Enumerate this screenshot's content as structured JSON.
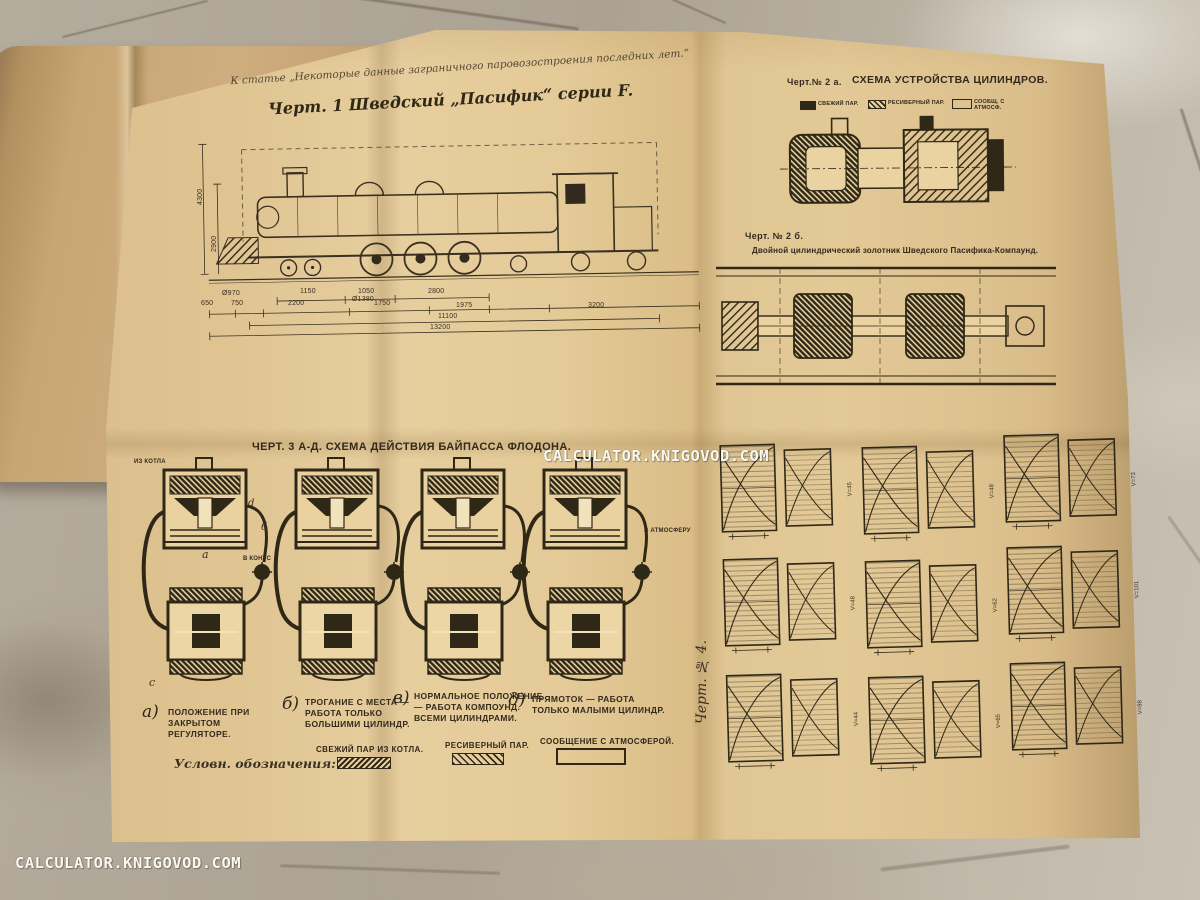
{
  "watermark": {
    "text": "CALCULATOR.KNIGOVOD.COM"
  },
  "page": {
    "article_note": "К статье „Некоторые данные заграничного паровозостроения последних лет.“",
    "fig1": {
      "title": "Черт. 1  Шведский „Пасифик“ серии F.",
      "vertical_dims": [
        "4300",
        "2900"
      ],
      "wheel_diameters": [
        "Ø970",
        "Ø1380"
      ],
      "dims_row1": [
        "1150",
        "1050",
        "2800"
      ],
      "dims_row2": [
        "650",
        "750",
        "2200",
        "1750",
        "1975",
        "3200"
      ],
      "dims_totals": [
        "11100",
        "13200"
      ]
    },
    "fig2a": {
      "label": "Черт.№ 2 а.",
      "title": "Схема устройства цилиндров.",
      "legend": [
        {
          "label": "свежий пар."
        },
        {
          "label": "ресиверный пар."
        },
        {
          "label": "сообщ. с атмосф."
        }
      ]
    },
    "fig2b": {
      "label": "Черт. № 2 б.",
      "caption": "Двойной цилиндрический золотник Шведского Пасифика-Компаунд."
    },
    "fig3": {
      "title": "Черт. 3 а-д.  Схема действия байпасса Флодона.",
      "annotations": {
        "from_boiler": "из котла",
        "to_cone": "в конус",
        "to_atmosphere": "в атмосферу",
        "letter_a": "а",
        "letter_b": "б",
        "letter_d": "d",
        "letter_e": "е",
        "letter_c": "с"
      },
      "captions": [
        {
          "letter": "а)",
          "text": "Положение при закрытом регуляторе."
        },
        {
          "letter": "б)",
          "text": "Трогание с места — работа только большими цилиндр."
        },
        {
          "letter": "в)",
          "text": "Нормальное положение — работа Компоунд. всеми цилиндрами."
        },
        {
          "letter": "д)",
          "text": "Прямоток — работа только малыми цилиндр."
        }
      ],
      "legend_title": "Условн. обозначения:",
      "legend": [
        {
          "label": "Свежий пар из котла."
        },
        {
          "label": "Ресиверный пар."
        },
        {
          "label": "Сообщение с атмосферой."
        }
      ]
    },
    "fig4": {
      "label": "Черт. № 4.",
      "cards": [
        {
          "v": "V=45"
        },
        {
          "v": "V=48"
        },
        {
          "v": "V=73"
        },
        {
          "v": "V=48"
        },
        {
          "v": "V=62"
        },
        {
          "v": "V=101"
        },
        {
          "v": "V=44"
        },
        {
          "v": "V=65"
        },
        {
          "v": "V=98"
        }
      ]
    }
  }
}
